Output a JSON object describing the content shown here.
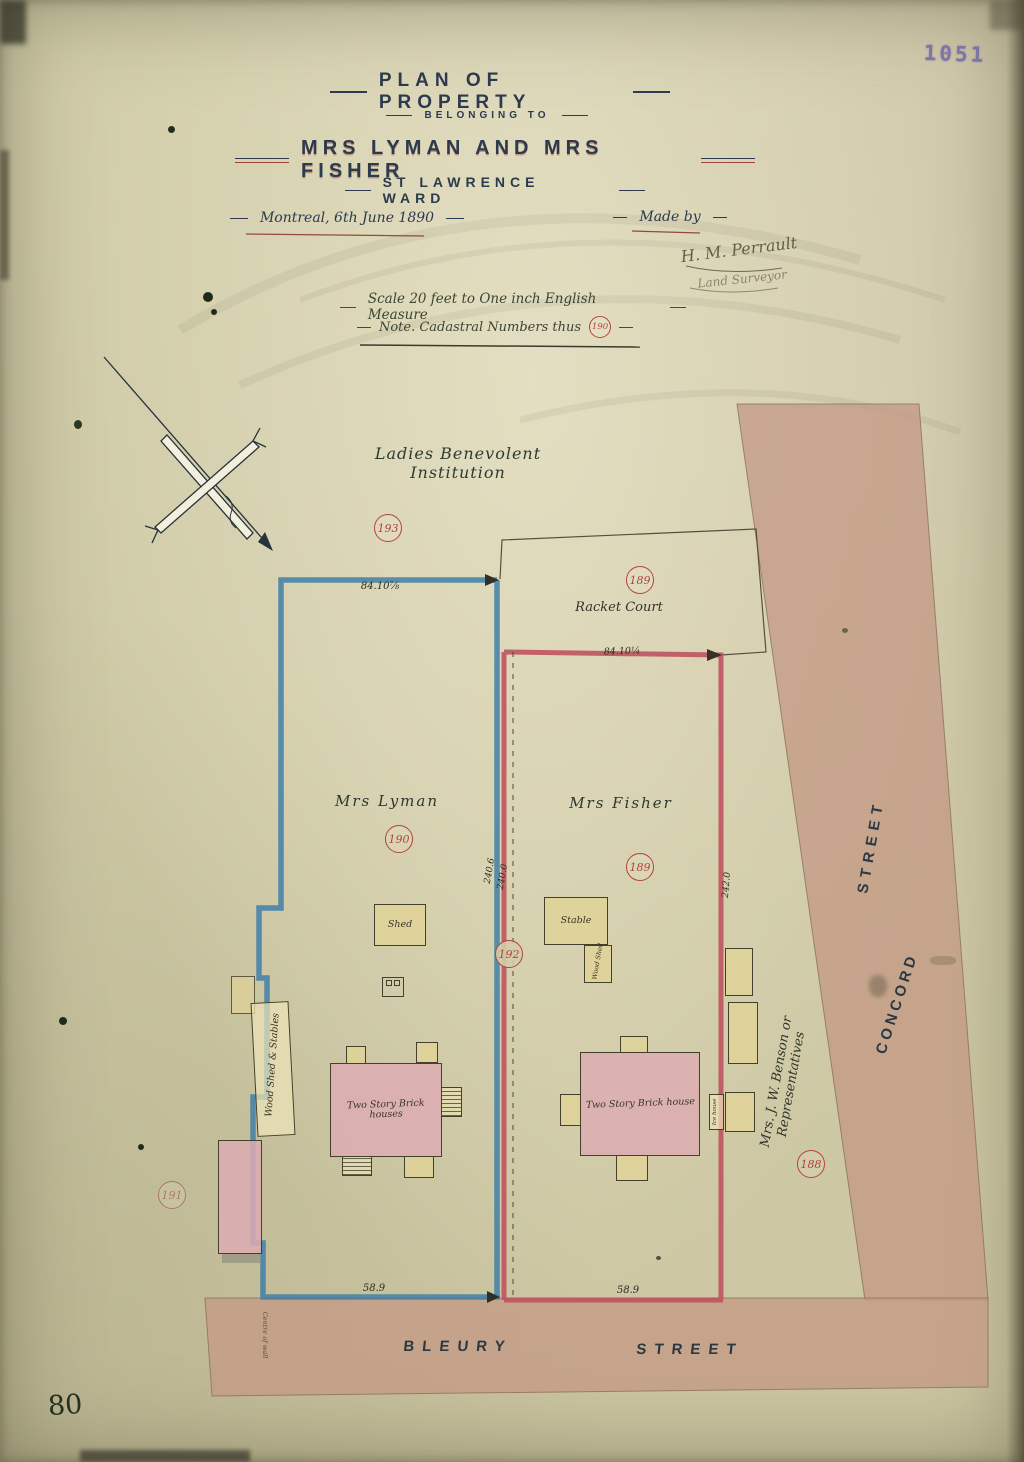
{
  "stamp": {
    "number": "1051"
  },
  "sheet_note": {
    "number": "80"
  },
  "title_block": {
    "title": "PLAN OF PROPERTY",
    "belonging": "BELONGING TO",
    "owners": "MRS LYMAN AND MRS FISHER",
    "ward": "ST LAWRENCE WARD",
    "place_date": "Montreal, 6th June 1890",
    "made_by": "Made by",
    "surveyor_signature": "H. M. Perrault",
    "surveyor_title": "Land Surveyor",
    "scale_note": "Scale 20 feet to One inch English Measure",
    "cadastral_note": "Note.  Cadastral Numbers thus",
    "cadastral_example": "190"
  },
  "map_labels": {
    "institution": "Ladies Benevolent Institution",
    "racket_court": "Racket Court",
    "lot_lyman": "Mrs Lyman",
    "lot_fisher": "Mrs Fisher",
    "benson": "Mrs. J. W. Benson or Representatives",
    "street_bleury": "BLEURY",
    "street_bleury2": "STREET",
    "street_right_word": "STREET",
    "street_right_name": "CONCORD",
    "centre_of_wall": "Centre of wall"
  },
  "buildings": {
    "shed": "Shed",
    "stable": "Stable",
    "wood_shed_stables": "Wood Shed & Stables",
    "wood_shed": "Wood Shed",
    "ice_house": "Ice house",
    "lyman_house": "Two Story Brick houses",
    "fisher_house": "Two Story Brick house"
  },
  "cadastral_numbers": {
    "n193": "193",
    "n189_court": "189",
    "n190": "190",
    "n189_lot": "189",
    "n192": "192",
    "n188": "188",
    "n191": "191"
  },
  "dimensions": {
    "lyman_front_top": "84.10⅞",
    "fisher_front_top": "84.10¼",
    "lyman_bleury": "58.9",
    "fisher_bleury": "58.9",
    "centre_line_west": "240.6",
    "centre_line_east": "240.0",
    "fisher_east_side": "242.0"
  },
  "colors": {
    "paper": "#d2cdab",
    "street_fill": "#c59c87",
    "lyman_boundary_blue": "#3f7fa8",
    "fisher_boundary_red": "#bf5360",
    "ink": "#2c3a52",
    "red_ink": "#b0453a",
    "brick_pink": "#dcaeb4",
    "wood_tan": "#e0d29a"
  }
}
